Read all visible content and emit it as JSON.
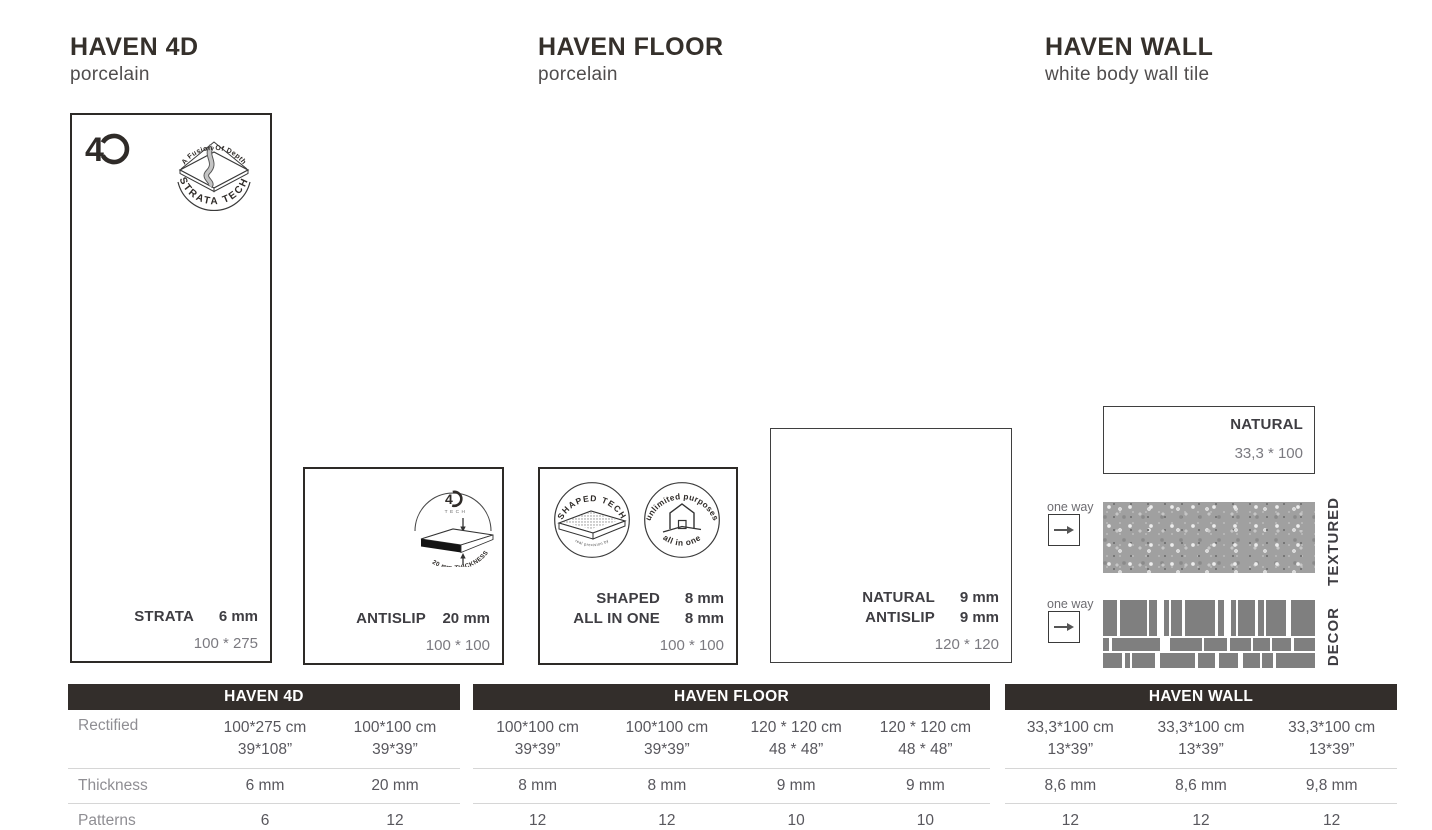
{
  "columns": [
    {
      "title": "HAVEN 4D",
      "subtitle": "porcelain"
    },
    {
      "title": "HAVEN FLOOR",
      "subtitle": "porcelain"
    },
    {
      "title": "HAVEN WALL",
      "subtitle": "white body wall tile"
    }
  ],
  "logos": {
    "four_d_mark": "4",
    "strata_badge": {
      "top_arc": "A Fusion Of Depth",
      "bottom_arc": "STRATA TECH"
    },
    "tech_diagram": {
      "mark": "4",
      "tech": "TECH",
      "arc": "20 mm THICKNESS"
    },
    "shaped_badge": {
      "top_arc": "SHAPED TECH",
      "bottom_arc": "real precision by"
    },
    "allinone_badge": {
      "top_arc": "unlimited purposes",
      "bottom_arc": "all in one"
    }
  },
  "tiles": [
    {
      "id": "strata",
      "specs": [
        {
          "label": "STRATA",
          "value": "6 mm"
        }
      ],
      "size": "100 * 275"
    },
    {
      "id": "antislip20",
      "specs": [
        {
          "label": "ANTISLIP",
          "value": "20 mm"
        }
      ],
      "size": "100 * 100"
    },
    {
      "id": "shaped",
      "specs": [
        {
          "label": "SHAPED",
          "value": "8 mm"
        },
        {
          "label": "ALL IN ONE",
          "value": "8 mm"
        }
      ],
      "size": "100 * 100"
    },
    {
      "id": "natural120",
      "specs": [
        {
          "label": "NATURAL",
          "value": "9 mm"
        },
        {
          "label": "ANTISLIP",
          "value": "9 mm"
        }
      ],
      "size": "120 * 120"
    },
    {
      "id": "naturalwall",
      "label": "NATURAL",
      "size": "33,3 * 100"
    }
  ],
  "wall": {
    "one_way": "one way",
    "textured_label": "TEXTURED",
    "decor_label": "DECOR"
  },
  "table": {
    "row_labels": [
      "Rectified",
      "Thickness",
      "Patterns"
    ],
    "sections": [
      {
        "header": "HAVEN 4D",
        "columns": [
          {
            "rectified": [
              "100*275 cm",
              "39*108”"
            ],
            "thickness": "6 mm",
            "patterns": "6"
          },
          {
            "rectified": [
              "100*100 cm",
              "39*39”"
            ],
            "thickness": "20 mm",
            "patterns": "12"
          }
        ]
      },
      {
        "header": "HAVEN FLOOR",
        "columns": [
          {
            "rectified": [
              "100*100 cm",
              "39*39”"
            ],
            "thickness": "8 mm",
            "patterns": "12"
          },
          {
            "rectified": [
              "100*100 cm",
              "39*39”"
            ],
            "thickness": "8 mm",
            "patterns": "12"
          },
          {
            "rectified": [
              "120 * 120 cm",
              "48 * 48”"
            ],
            "thickness": "9 mm",
            "patterns": "10"
          },
          {
            "rectified": [
              "120 * 120 cm",
              "48 * 48”"
            ],
            "thickness": "9 mm",
            "patterns": "10"
          }
        ]
      },
      {
        "header": "HAVEN WALL",
        "columns": [
          {
            "rectified": [
              "33,3*100 cm",
              "13*39”"
            ],
            "thickness": "8,6 mm",
            "patterns": "12"
          },
          {
            "rectified": [
              "33,3*100 cm",
              "13*39”"
            ],
            "thickness": "8,6 mm",
            "patterns": "12"
          },
          {
            "rectified": [
              "33,3*100 cm",
              "13*39”"
            ],
            "thickness": "9,8 mm",
            "patterns": "12"
          }
        ]
      }
    ]
  },
  "colors": {
    "header_bar": "#332e2b",
    "heading_text": "#35302b",
    "spec_text": "#3e3d42",
    "size_text": "#7b7a80",
    "row_label": "#8f8e93",
    "cell_text": "#58575d"
  }
}
